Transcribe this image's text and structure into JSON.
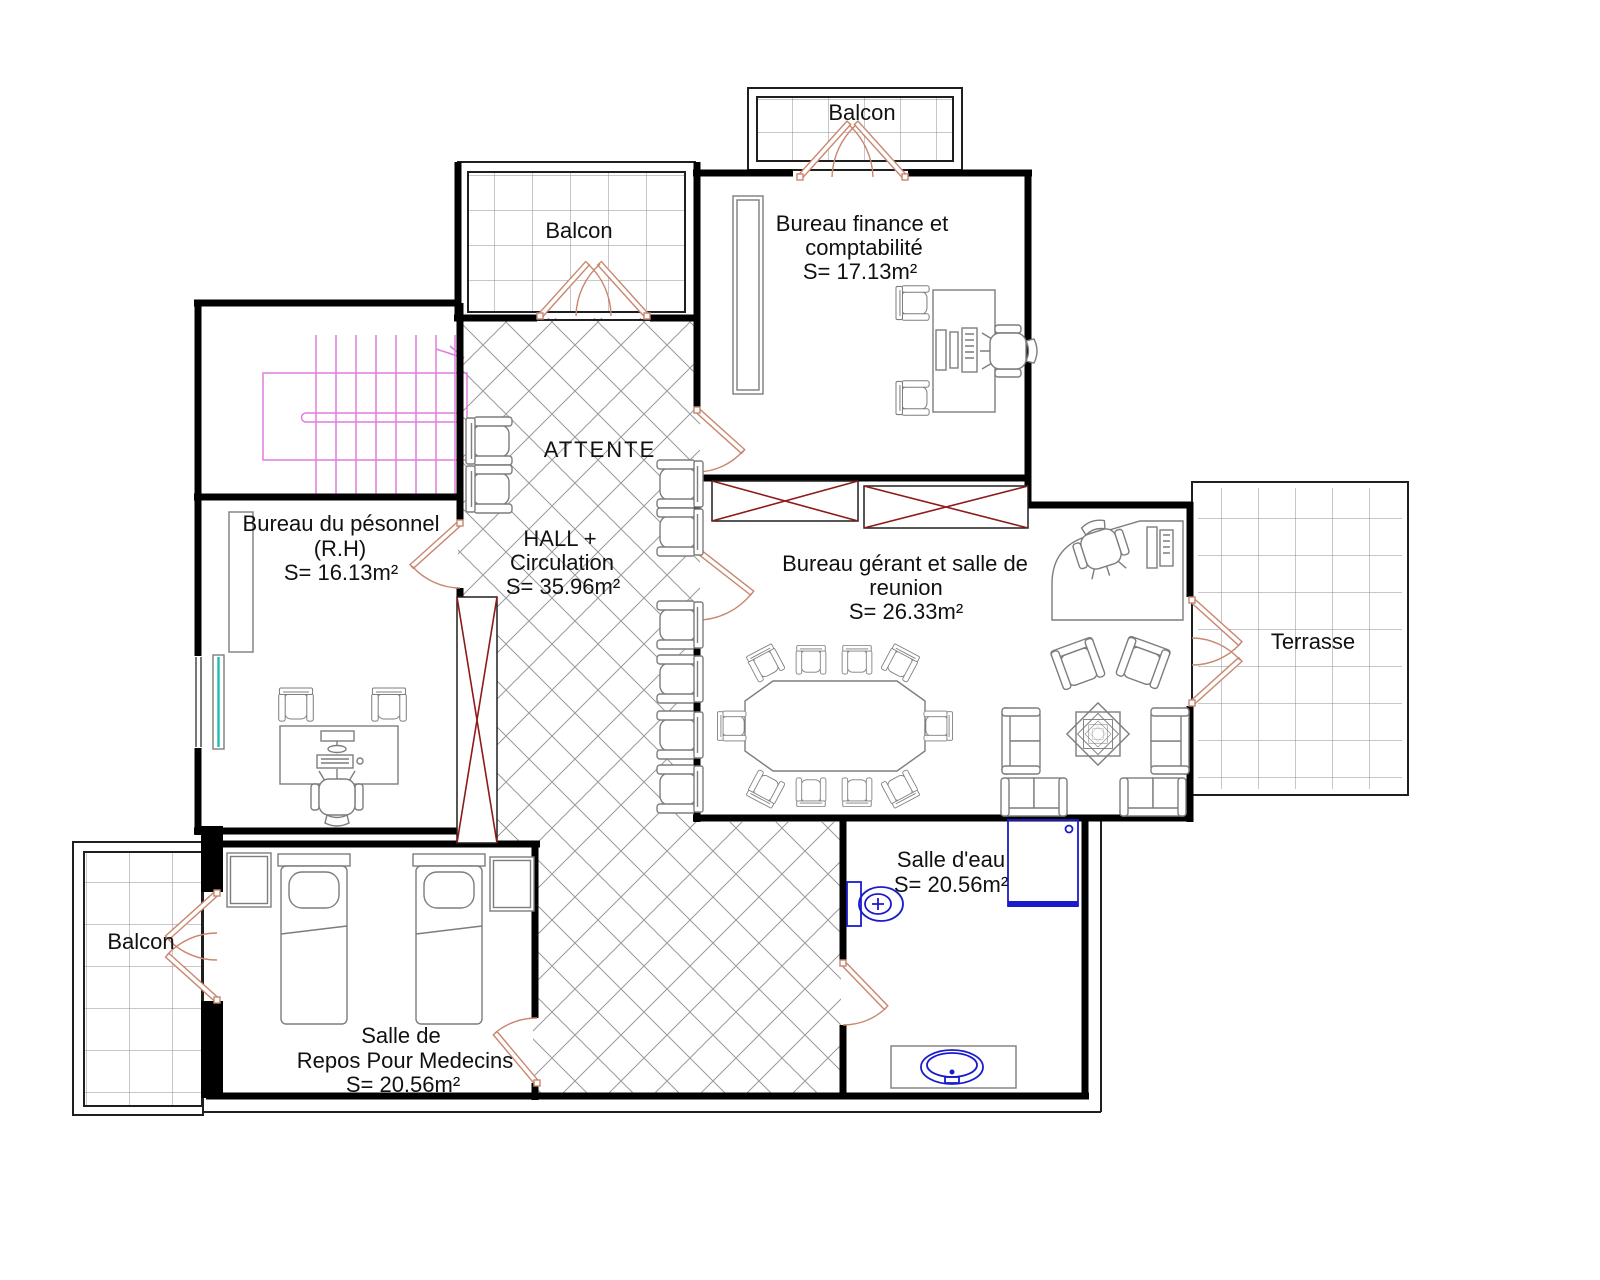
{
  "colors": {
    "wall": "#000000",
    "line": "#7d7d7d",
    "thin": "#1f1f1f",
    "tile": "#8f8f8f",
    "lattice": "#98999e",
    "door": "#c9866e",
    "stair": "#e07ddf",
    "shaft": "#8e1a1a",
    "fixture": "#1b1bcc",
    "window": "#26bdbd",
    "text": "#111111"
  },
  "rooms": {
    "balcon_top": {
      "label": "Balcon"
    },
    "balcon_mid": {
      "label": "Balcon"
    },
    "balcon_bottom": {
      "label": "Balcon"
    },
    "finance": {
      "name_line1": "Bureau finance et",
      "name_line2": "comptabilité",
      "area": "S= 17.13m²"
    },
    "attente": {
      "label": "ATTENTE"
    },
    "hall": {
      "name_line1": "HALL +",
      "name_line2": "Circulation",
      "area": "S= 35.96m²"
    },
    "personnel": {
      "name_line1": "Bureau du pésonnel",
      "name_line2": "(R.H)",
      "area": "S= 16.13m²"
    },
    "gerant": {
      "name_line1": "Bureau gérant et salle de",
      "name_line2": "reunion",
      "area": "S= 26.33m²"
    },
    "terrasse": {
      "label": "Terrasse"
    },
    "salle_eau": {
      "name": "Salle d'eau",
      "area": "S= 20.56m²"
    },
    "repos": {
      "name_line1": "Salle de",
      "name_line2": "Repos Pour Medecins",
      "area": "S= 20.56m²"
    }
  }
}
